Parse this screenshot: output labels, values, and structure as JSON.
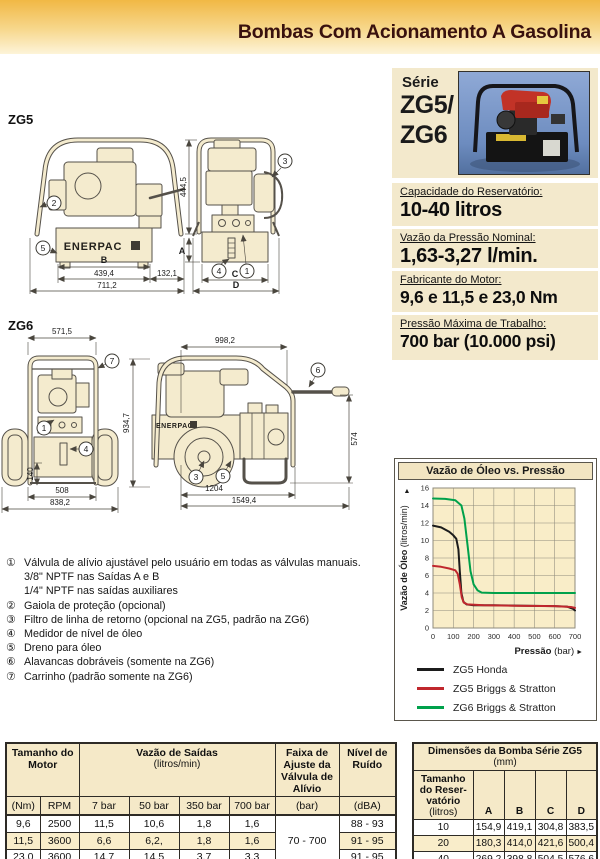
{
  "header": {
    "title": "Bombas Com Acionamento A Gasolina"
  },
  "series_panel": {
    "series_word": "Série",
    "model_top": "ZG5/",
    "model_bottom": "ZG6"
  },
  "specs": [
    {
      "label": "Capacidade do Reservatório:",
      "value": "10-40 litros"
    },
    {
      "label": "Vazão da Pressão Nominal:",
      "value": "1,63-3,27 l/min."
    },
    {
      "label": "Fabricante do Motor:",
      "value": "9,6 e 11,5 e 23,0 Nm"
    },
    {
      "label": "Pressão Máxima de Trabalho:",
      "value": "700 bar (10.000 psi)"
    }
  ],
  "diagrams": {
    "brand": "ENERPAC",
    "zg5": {
      "label": "ZG5",
      "dims": {
        "b": "B",
        "a": "A",
        "c": "C",
        "d": "D",
        "w1": "439,4",
        "w2": "132,1",
        "w3": "711,2",
        "h1": "444,5"
      }
    },
    "zg6": {
      "label": "ZG6",
      "dims": {
        "top": "571,5",
        "h_small": "140",
        "w1": "508",
        "w2": "838,2",
        "h1": "934,7",
        "top2": "998,2",
        "h2": "574",
        "w3": "1204",
        "w4": "1549,4"
      }
    },
    "callouts": {
      "c1": "1",
      "c2": "2",
      "c3": "3",
      "c4": "4",
      "c5": "5",
      "c6": "6",
      "c7": "7"
    }
  },
  "footnotes": [
    {
      "marker": "①",
      "text": "Válvula de alívio ajustável pelo usuário em todas as válvulas manuais."
    },
    {
      "marker": "",
      "text": "3/8\" NPTF nas Saídas A e B"
    },
    {
      "marker": "",
      "text": "1/4\" NPTF nas saídas auxiliares"
    },
    {
      "marker": "②",
      "text": "Gaiola de proteção (opcional)"
    },
    {
      "marker": "③",
      "text": "Filtro de linha de retorno (opcional na ZG5, padrão na ZG6)"
    },
    {
      "marker": "④",
      "text": "Medidor de nível de óleo"
    },
    {
      "marker": "⑤",
      "text": "Dreno para óleo"
    },
    {
      "marker": "⑥",
      "text": "Alavancas dobráveis (somente na ZG6)"
    },
    {
      "marker": "⑦",
      "text": "Carrinho (padrão somente na ZG6)"
    }
  ],
  "chart_data": {
    "type": "line",
    "title": "Vazão de Óleo vs. Pressão",
    "ylabel_bold": "Vazão de Óleo",
    "ylabel_unit": "(litros/min)",
    "xlabel_bold": "Pressão",
    "xlabel_unit": "(bar)",
    "xlim": [
      0,
      700
    ],
    "ylim": [
      0,
      16
    ],
    "xtick_step": 100,
    "ytick_step": 2,
    "grid": true,
    "legend_position": "below",
    "plot_bg": "#f9edc8",
    "grid_color": "#8f8b7c",
    "series": [
      {
        "name": "ZG5 Honda",
        "color": "#1c1c1c",
        "points": [
          [
            0,
            11.7
          ],
          [
            40,
            11.5
          ],
          [
            80,
            11.0
          ],
          [
            100,
            10.6
          ],
          [
            115,
            10.2
          ],
          [
            125,
            9.0
          ],
          [
            132,
            6.5
          ],
          [
            140,
            4.0
          ],
          [
            150,
            3.0
          ],
          [
            165,
            2.7
          ],
          [
            200,
            2.6
          ],
          [
            300,
            2.6
          ],
          [
            450,
            2.55
          ],
          [
            600,
            2.5
          ],
          [
            660,
            2.45
          ],
          [
            690,
            2.2
          ],
          [
            700,
            2.0
          ]
        ]
      },
      {
        "name": "ZG5 Briggs & Stratton",
        "color": "#c0272d",
        "points": [
          [
            0,
            7.1
          ],
          [
            40,
            7.0
          ],
          [
            80,
            6.8
          ],
          [
            110,
            6.6
          ],
          [
            122,
            6.2
          ],
          [
            132,
            5.0
          ],
          [
            142,
            3.5
          ],
          [
            152,
            2.9
          ],
          [
            170,
            2.7
          ],
          [
            250,
            2.6
          ],
          [
            400,
            2.55
          ],
          [
            600,
            2.5
          ],
          [
            680,
            2.4
          ],
          [
            700,
            2.3
          ]
        ]
      },
      {
        "name": "ZG6 Briggs & Stratton",
        "color": "#00a14b",
        "points": [
          [
            0,
            14.8
          ],
          [
            60,
            14.75
          ],
          [
            110,
            14.6
          ],
          [
            140,
            14.0
          ],
          [
            155,
            12.5
          ],
          [
            170,
            9.5
          ],
          [
            185,
            6.5
          ],
          [
            200,
            5.0
          ],
          [
            220,
            4.3
          ],
          [
            240,
            4.05
          ],
          [
            300,
            4.0
          ],
          [
            500,
            4.0
          ],
          [
            700,
            4.0
          ]
        ]
      }
    ]
  },
  "left_table": {
    "group_headers": [
      "Tamanho do Motor",
      "Vazão de Saídas",
      "(litros/min)",
      "Faixa de Ajuste da Válvula de Alívio",
      "Nível de Ruído"
    ],
    "units": [
      "(Nm)",
      "RPM",
      "7 bar",
      "50 bar",
      "350 bar",
      "700 bar",
      "(bar)",
      "(dBA)"
    ],
    "relief_range": "70 - 700",
    "rows": [
      [
        "9,6",
        "2500",
        "11,5",
        "10,6",
        "1,8",
        "1,6",
        "88 - 93"
      ],
      [
        "11,5",
        "3600",
        "6,6",
        "6,2,",
        "1,8",
        "1,6",
        "91 - 95"
      ],
      [
        "23,0",
        "3600",
        "14,7",
        "14,5",
        "3,7",
        "3,3",
        "91 - 95"
      ]
    ]
  },
  "right_table": {
    "title": "Dimensões da Bomba Série ZG5",
    "title_unit": "(mm)",
    "col1_lines": [
      "Tamanho",
      "do Reser-",
      "vatório"
    ],
    "col1_unit": "(litros)",
    "cols": [
      "A",
      "B",
      "C",
      "D"
    ],
    "rows": [
      [
        "10",
        "154,9",
        "419,1",
        "304,8",
        "383,5"
      ],
      [
        "20",
        "180,3",
        "414,0",
        "421,6",
        "500,4"
      ],
      [
        "40",
        "269,2",
        "398,8",
        "504,5",
        "576,6"
      ]
    ]
  }
}
